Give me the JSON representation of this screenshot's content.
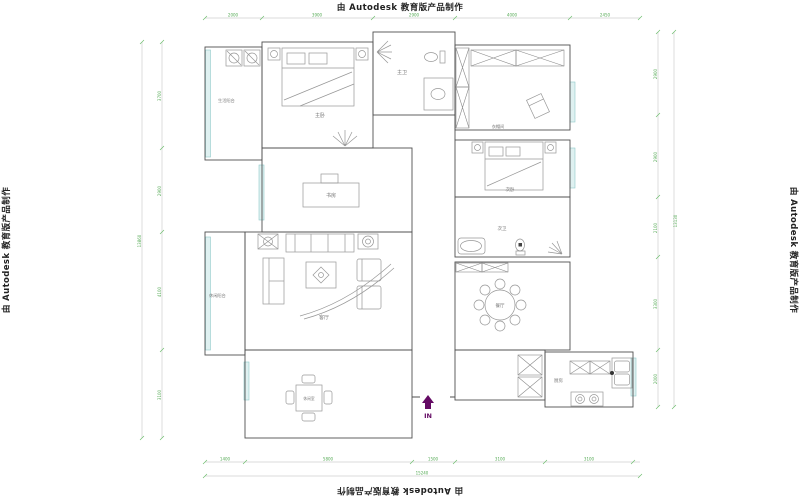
{
  "watermark": {
    "text": "由 Autodesk 教育版产品制作"
  },
  "rooms": {
    "utility_balcony": "生活阳台",
    "master_bedroom": "主卧",
    "master_bath": "主卫",
    "cloak_room": "衣帽间",
    "second_bedroom": "次卧",
    "second_bath": "次卫",
    "study": "书房",
    "living_room": "客厅",
    "dining_room": "餐厅",
    "kitchen": "厨房",
    "leisure_balcony": "休闲阳台",
    "leisure_room": "休闲室"
  },
  "entrance": {
    "label": "IN"
  },
  "dims": {
    "top": [
      "2000",
      "3900",
      "2900",
      "4000",
      "2450"
    ],
    "bottom": [
      "1400",
      "5800",
      "1500",
      "3100",
      "3100"
    ],
    "bottom_total": "15240",
    "left": [
      "3700",
      "2900",
      "4100",
      "3100"
    ],
    "left_total": "13860",
    "right": [
      "2900",
      "2900",
      "2100",
      "3300",
      "2000"
    ],
    "right_total": "13130"
  },
  "colors": {
    "wall": "#4f4f4f",
    "furniture": "#979797",
    "window_glass": "#dff1f1",
    "window_frame": "#8fcaca",
    "dimension_green": "#55aa55",
    "entrance_purple": "#640a64",
    "watermark_text": "#222222"
  }
}
